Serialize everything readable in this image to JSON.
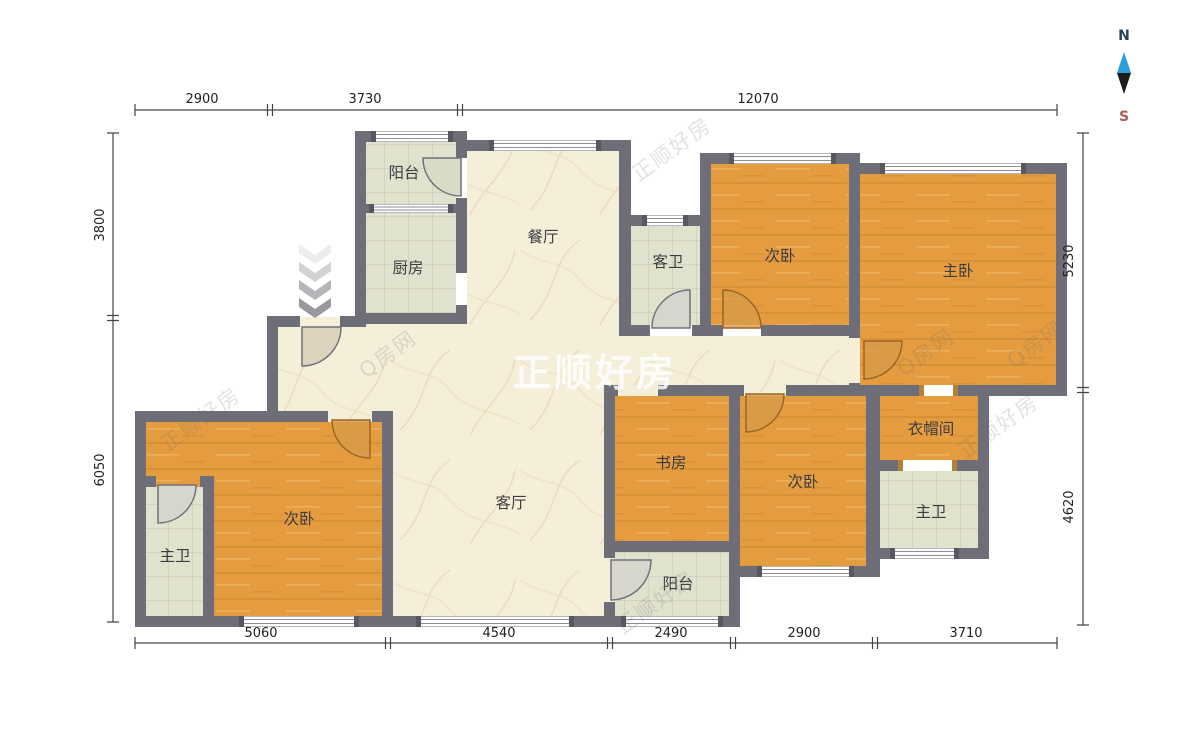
{
  "compass": {
    "north": "N",
    "south": "S"
  },
  "watermark": {
    "primary": "正顺好房",
    "secondary": "Q房网"
  },
  "rooms": {
    "balcony_top": "阳台",
    "kitchen": "厨房",
    "dining": "餐厅",
    "guest_bath": "客卫",
    "bedroom_top": "次卧",
    "master_bedroom": "主卧",
    "study": "书房",
    "bedroom_bottom": "次卧",
    "cloakroom": "衣帽间",
    "master_bath_right": "主卫",
    "bedroom_left": "次卧",
    "master_bath_left": "主卫",
    "living": "客厅",
    "balcony_bottom": "阳台"
  },
  "dimensions": {
    "top": [
      "2900",
      "3730",
      "12070"
    ],
    "bottom": [
      "5060",
      "4540",
      "2490",
      "2900",
      "3710"
    ],
    "left": [
      "3800",
      "6050"
    ],
    "right": [
      "5230",
      "4620"
    ]
  },
  "colors": {
    "wall": "#6e6e78",
    "wood_floor": "#e49c3f",
    "marble_floor": "#f5eed9",
    "tile_floor": "#e1e2cd",
    "door_wood": "#d79b4a",
    "compass_north_blue": "#2a9fd8",
    "compass_south_red": "#b05a52"
  }
}
